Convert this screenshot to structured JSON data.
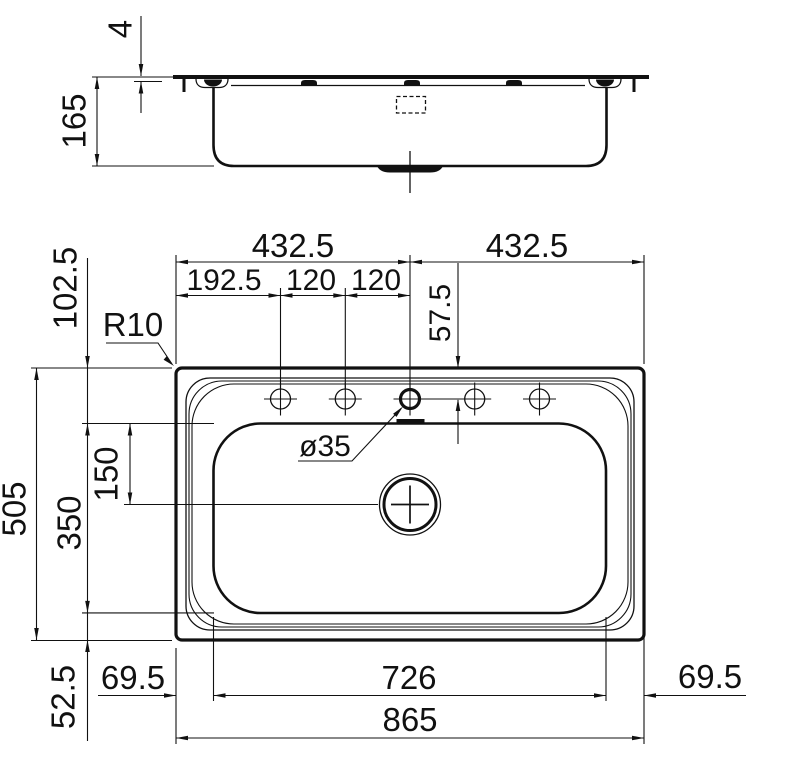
{
  "drawing": {
    "kind": "sink technical dimension drawing",
    "line_color": "#111111",
    "background": "#ffffff"
  },
  "side_view": {
    "dim_rim_lip": "4",
    "dim_depth": "165"
  },
  "plan_view": {
    "dim_top_left_half": "432.5",
    "dim_top_right_half": "432.5",
    "dim_hole_offset": "192.5",
    "dim_hole_pitch_1": "120",
    "dim_hole_pitch_2": "120",
    "dim_hole_row": "57.5",
    "dim_rim_to_bowl": "102.5",
    "label_corner_radius": "R10",
    "label_hole_diameter": "ø35",
    "dim_drain_offset": "150",
    "dim_bowl_front_back": "350",
    "dim_overall_depth": "505",
    "dim_bowl_to_edge": "52.5",
    "dim_margin_left": "69.5",
    "dim_bowl_width": "726",
    "dim_overall_width": "865",
    "dim_margin_right": "69.5"
  }
}
